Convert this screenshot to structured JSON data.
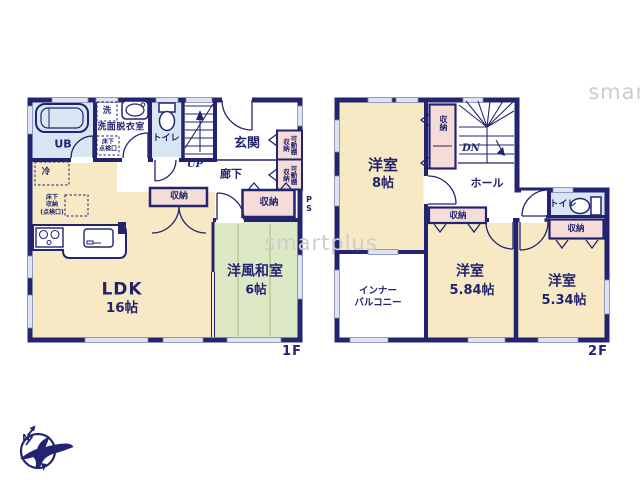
{
  "watermark": {
    "text": "smartplus"
  },
  "colors": {
    "wall": "#232470",
    "room_cream": "#f7e9c4",
    "room_green": "#dde8c4",
    "room_blue": "#d8e6f3",
    "closet_pink": "#f6dcd6",
    "window": "#dfe4f2",
    "watermark": "#cdcdcd"
  },
  "floor1": {
    "label": "1F",
    "rooms": {
      "ldk": {
        "name": "LDK",
        "area": "16帖"
      },
      "japanese_room": {
        "name": "洋風和室",
        "area": "6帖"
      },
      "bath": {
        "name": "UB"
      },
      "washroom": {
        "name": "洗面脱衣室"
      },
      "laundry": {
        "name": "洗"
      },
      "toilet": {
        "name": "トイレ"
      },
      "entrance": {
        "name": "玄関"
      },
      "hallway": {
        "name": "廊下"
      },
      "stairs": {
        "name": "UP"
      }
    },
    "labels": {
      "refrigerator": "冷",
      "underfloor_storage": "床下\n収納\n(点検口)",
      "underfloor_access": "床下\n点検口",
      "storage_hall": "収納",
      "storage_entrance": "収納",
      "shelf_storage": "収納",
      "movable_shelf": "可動棚",
      "pipe_space": "P\nS"
    }
  },
  "floor2": {
    "label": "2F",
    "rooms": {
      "bedroom_8": {
        "name": "洋室",
        "area": "8帖"
      },
      "bedroom_584": {
        "name": "洋室",
        "area": "5.84帖"
      },
      "bedroom_534": {
        "name": "洋室",
        "area": "5.34帖"
      },
      "hall": {
        "name": "ホール"
      },
      "toilet": {
        "name": "トイレ"
      },
      "inner_balcony": {
        "name": "インナー\nバルコニー"
      },
      "stairs": {
        "name": "DN"
      }
    },
    "labels": {
      "closet_stairs": "収納",
      "closet_mid": "収納",
      "closet_534": "収納"
    }
  },
  "compass": {
    "north": "N"
  }
}
